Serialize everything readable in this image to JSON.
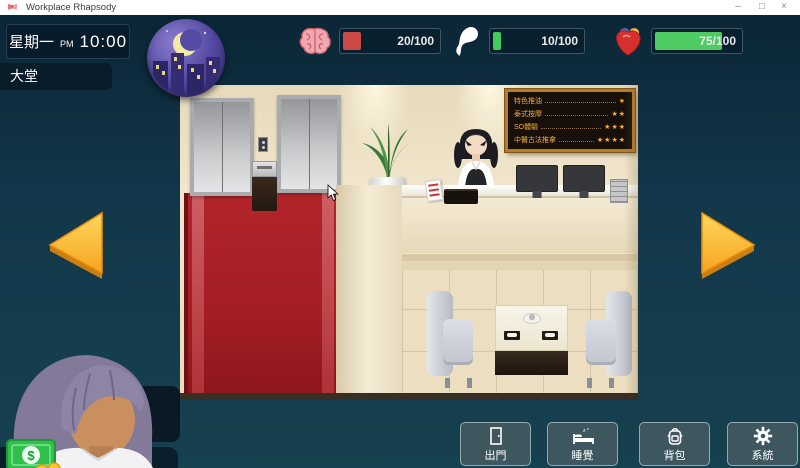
{
  "window": {
    "title": "Workplace Rhapsody",
    "minimize": "–",
    "maximize": "□",
    "close": "×"
  },
  "hud": {
    "day": "星期一",
    "meridiem": "PM",
    "time": "10:00",
    "location": "大堂",
    "stats": [
      {
        "name": "brain",
        "icon": "brain-icon",
        "value": "20/100",
        "pct": 18,
        "color": "#cb4a46"
      },
      {
        "name": "spirit",
        "icon": "spirit-icon",
        "value": "10/100",
        "pct": 8,
        "color": "#43cb5e"
      },
      {
        "name": "heart",
        "icon": "heart-icon",
        "value": "75/100",
        "pct": 74,
        "color": "#4ecb63"
      }
    ]
  },
  "scene": {
    "menu_board": {
      "items": [
        {
          "label": "特色推油",
          "stars": "★"
        },
        {
          "label": "泰式按摩",
          "stars": "★★"
        },
        {
          "label": "SO體驗",
          "stars": "★★★"
        },
        {
          "label": "中醫古法推拿",
          "stars": "★★★★"
        }
      ]
    }
  },
  "player": {
    "position_label": "職位：",
    "position_value": "小職員",
    "salary_label": "日薪：",
    "salary_value": "100",
    "exp_label": "經驗：",
    "exp_value": "10/100",
    "money": "850"
  },
  "actions": [
    {
      "label": "出門",
      "icon": "door-icon"
    },
    {
      "label": "睡覺",
      "icon": "bed-icon"
    },
    {
      "label": "背包",
      "icon": "backpack-icon"
    },
    {
      "label": "系統",
      "icon": "gear-icon"
    }
  ]
}
